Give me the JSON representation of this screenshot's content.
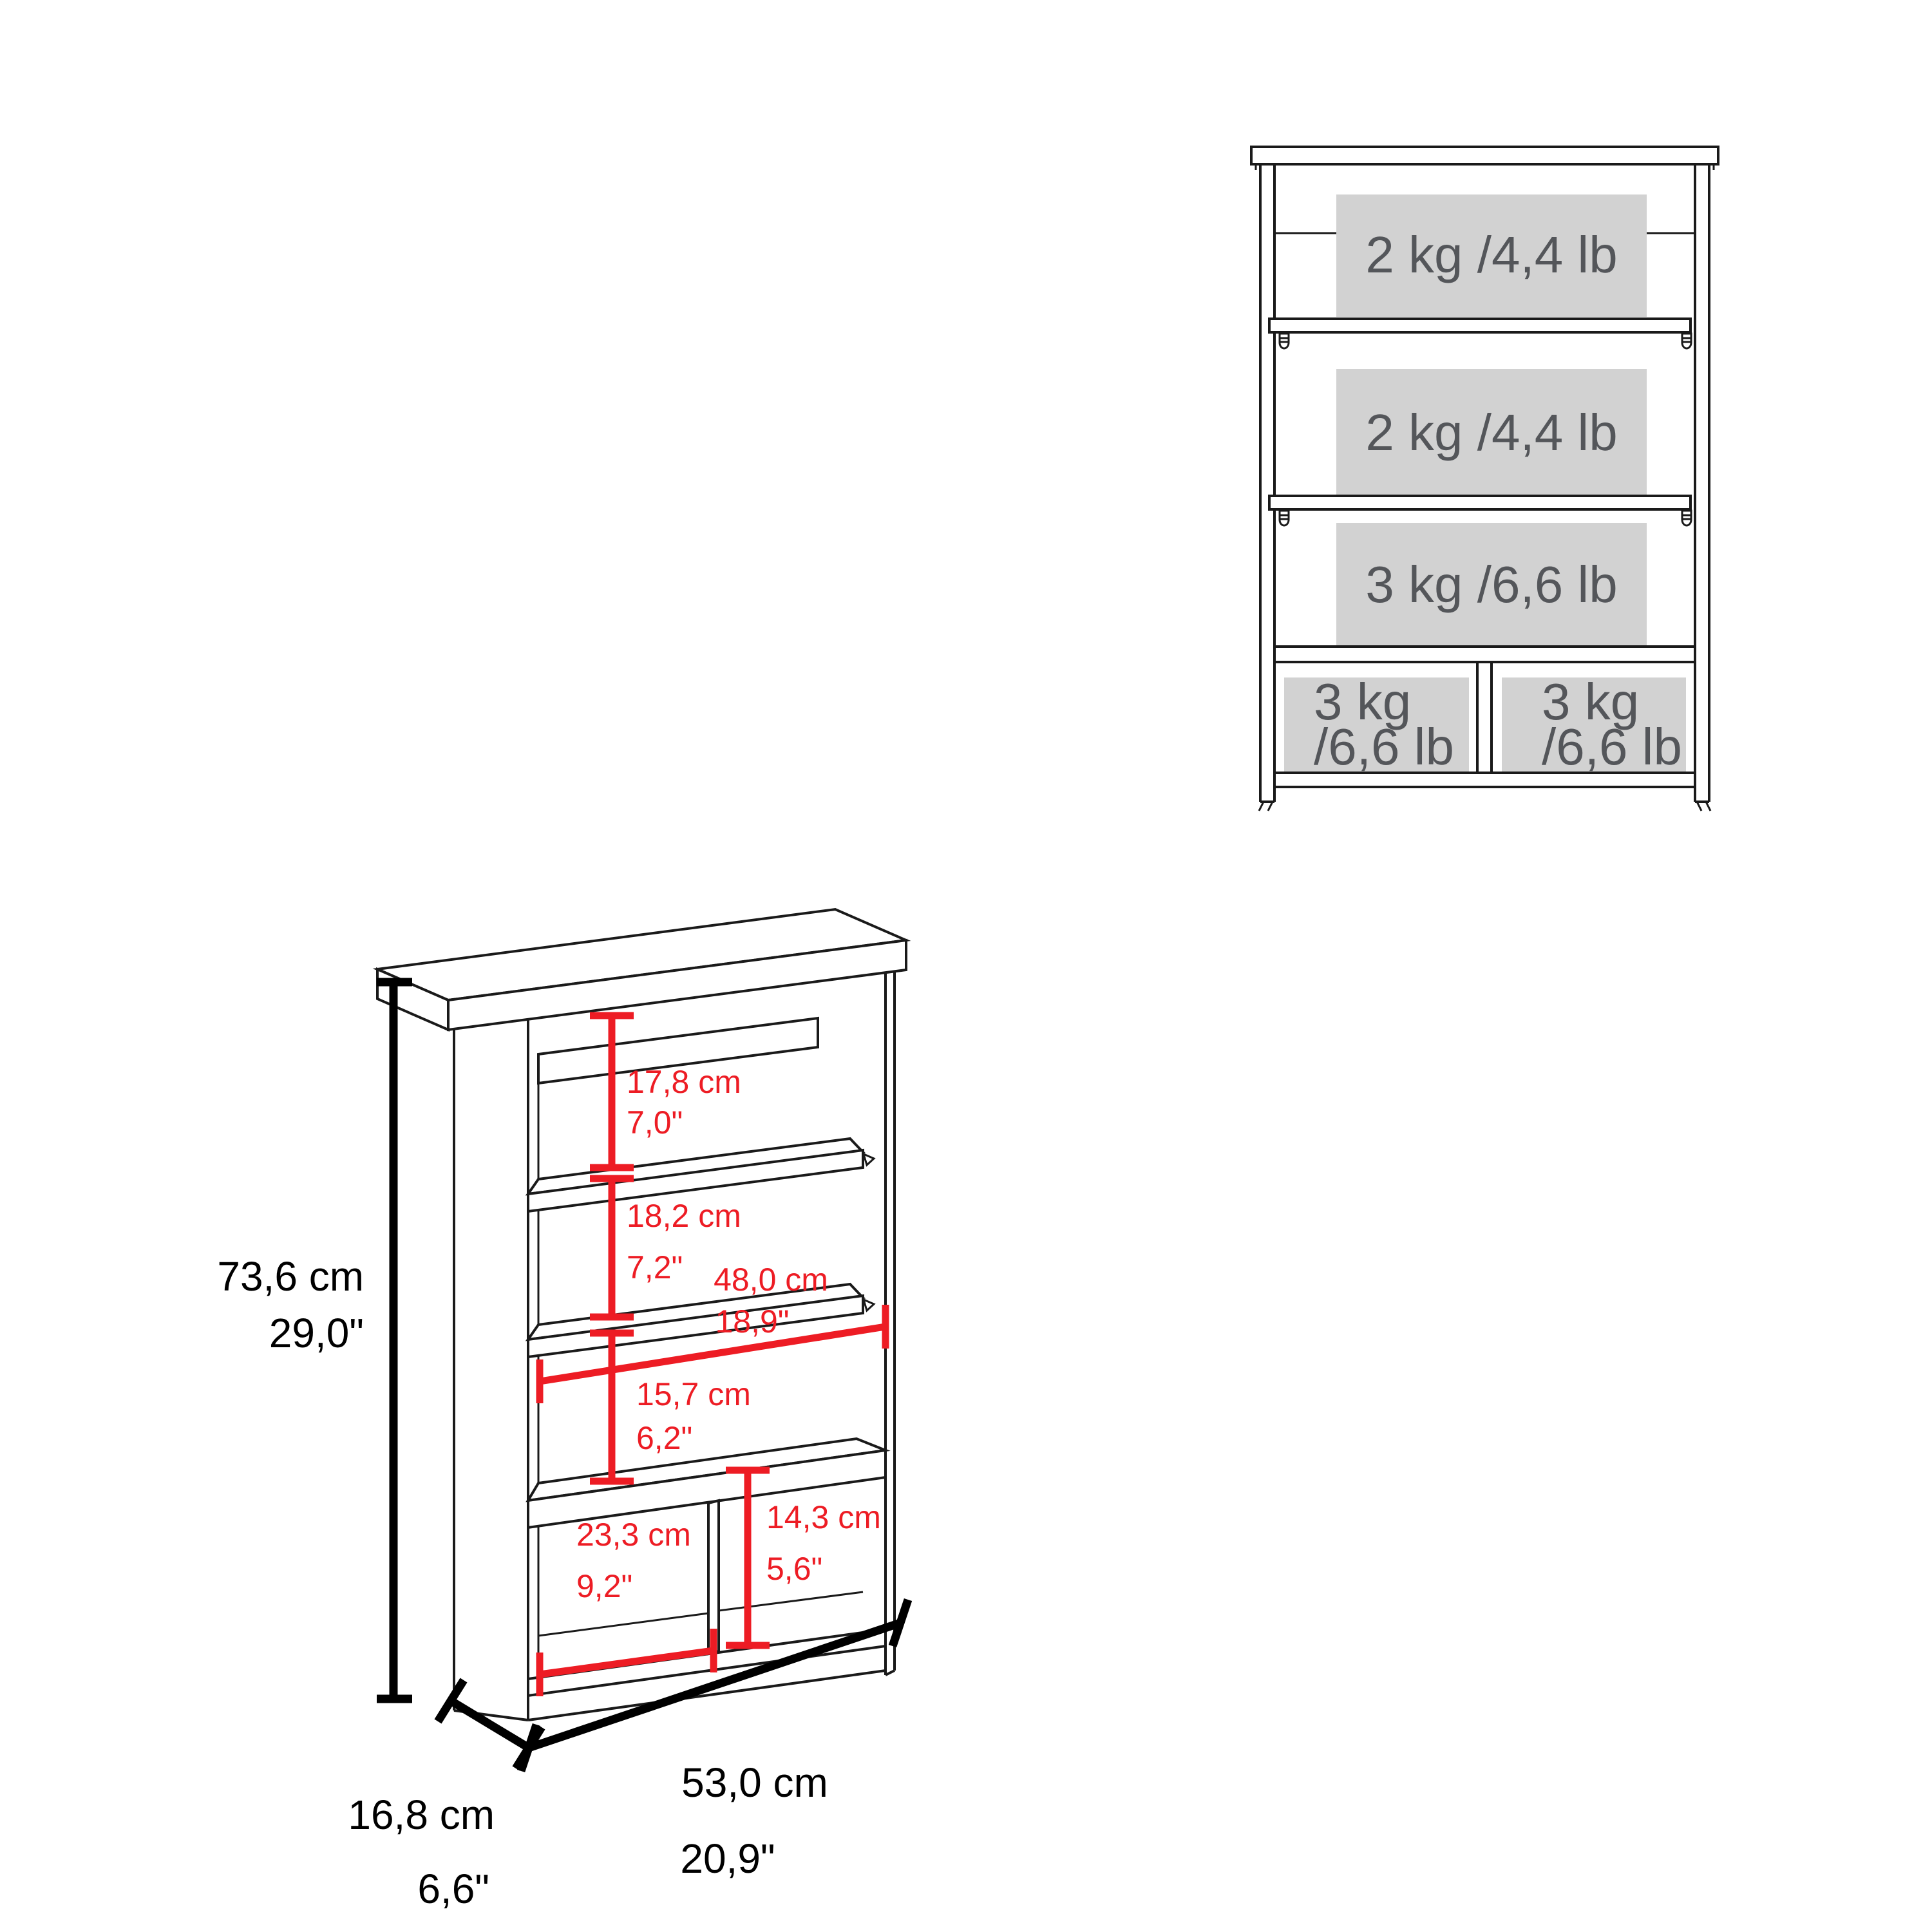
{
  "front_view": {
    "areas": [
      {
        "label": "2 kg /4,4 lb"
      },
      {
        "label": "2 kg /4,4 lb"
      },
      {
        "label": "3 kg /6,6 lb"
      }
    ],
    "cubbies": [
      {
        "line1": "3 kg",
        "line2": "/6,6 lb"
      },
      {
        "line1": "3 kg",
        "line2": "/6,6 lb"
      }
    ]
  },
  "dims": {
    "height": {
      "cm": "73,6 cm",
      "in": "29,0\""
    },
    "depth": {
      "cm": "16,8 cm",
      "in": "6,6\""
    },
    "width": {
      "cm": "53,0 cm",
      "in": "20,9\""
    },
    "section_top": {
      "cm": "17,8 cm",
      "in": "7,0\""
    },
    "section_middle": {
      "cm": "18,2 cm",
      "in": "7,2\""
    },
    "shelf_width": {
      "cm": "48,0 cm",
      "in": "18,9\""
    },
    "section_lower": {
      "cm": "15,7 cm",
      "in": "6,2\""
    },
    "cubby_width": {
      "cm": "23,3 cm",
      "in": "9,2\""
    },
    "cubby_height": {
      "cm": "14,3 cm",
      "in": "5,6\""
    }
  },
  "colors": {
    "dimension_red": "#ed1c24",
    "line_black": "#1a1a1a",
    "capacity_area_fill": "#d2d2d2",
    "capacity_text": "#54565a"
  }
}
